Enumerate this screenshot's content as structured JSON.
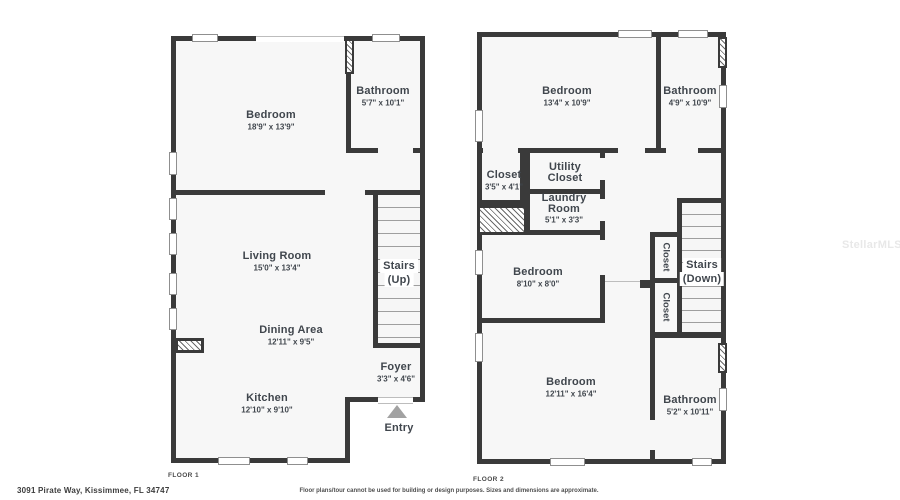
{
  "watermark": "StellarMLS",
  "footer": {
    "address": "3091 Pirate Way, Kissimmee, FL 34747",
    "disclaimer": "Floor plans/tour cannot be used for building or design purposes. Sizes and dimensions are approximate."
  },
  "floor1": {
    "label": "FLOOR 1",
    "rooms": {
      "bedroom": {
        "name": "Bedroom",
        "dims": "18'9\" x 13'9\""
      },
      "bathroom": {
        "name": "Bathroom",
        "dims": "5'7\" x 10'1\""
      },
      "living": {
        "name": "Living Room",
        "dims": "15'0\" x 13'4\""
      },
      "dining": {
        "name": "Dining Area",
        "dims": "12'11\" x 9'5\""
      },
      "kitchen": {
        "name": "Kitchen",
        "dims": "12'10\" x 9'10\""
      },
      "stairs": {
        "name": "Stairs",
        "sub": "(Up)"
      },
      "foyer": {
        "name": "Foyer",
        "dims": "3'3\" x 4'6\""
      },
      "entry": {
        "name": "Entry"
      }
    }
  },
  "floor2": {
    "label": "FLOOR 2",
    "rooms": {
      "bedroom_top": {
        "name": "Bedroom",
        "dims": "13'4\" x 10'9\""
      },
      "bathroom_top": {
        "name": "Bathroom",
        "dims": "4'9\" x 10'9\""
      },
      "closet_tl": {
        "name": "Closet",
        "dims": "3'5\" x 4'1\""
      },
      "utility": {
        "name": "Utility Closet"
      },
      "laundry": {
        "name": "Laundry Room",
        "dims": "5'1\" x 3'3\""
      },
      "bedroom_mid": {
        "name": "Bedroom",
        "dims": "8'10\" x 8'0\""
      },
      "closet_upper": {
        "name": "Closet"
      },
      "closet_lower": {
        "name": "Closet"
      },
      "stairs": {
        "name": "Stairs",
        "sub": "(Down)"
      },
      "bedroom_bottom": {
        "name": "Bedroom",
        "dims": "12'11\" x 16'4\""
      },
      "bathroom_bottom": {
        "name": "Bathroom",
        "dims": "5'2\" x 10'11\""
      }
    }
  }
}
